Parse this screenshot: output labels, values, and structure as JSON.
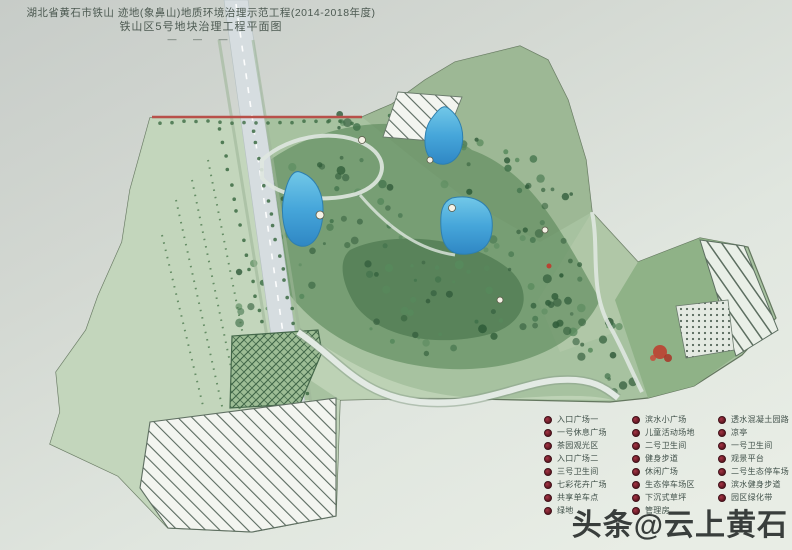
{
  "title": {
    "line1": "湖北省黄石市铁山 迹地(象鼻山)地质环境治理示范工程(2014-2018年度)",
    "line2": "铁山区5号地块治理工程平面图",
    "scale_marks": "— — —"
  },
  "watermark": "头条@云上黄石",
  "legend": {
    "columns": [
      [
        "入口广场一",
        "一号休息广场",
        "茶园观光区",
        "入口广场二",
        "三号卫生间",
        "七彩花卉广场",
        "共享单车点",
        "绿地"
      ],
      [
        "滨水小广场",
        "儿童活动场地",
        "二号卫生间",
        "健身步道",
        "休闲广场",
        "生态停车场区",
        "下沉式草坪",
        "管理房"
      ],
      [
        "透水混凝土园路",
        "凉亭",
        "一号卫生间",
        "观景平台",
        "二号生态停车场",
        "滨水健身步道",
        "园区绿化带"
      ]
    ]
  },
  "map_features": {
    "park": "治理区绿地",
    "ponds": [
      "西侧水塘",
      "北侧水塘",
      "中部水塘"
    ],
    "road": "纵向道路",
    "red_boundary_line": "北侧红线",
    "hatched_zones": [
      "北部整治区",
      "中部网格整治区",
      "南部大面积整治区",
      "东部条带停车区",
      "东部网点区"
    ]
  },
  "colors": {
    "background_top": "#c7ccc8",
    "background_bottom": "#e7ece4",
    "park_green": "#a7c2a0",
    "lawn_green": "#c6d8bf",
    "forest_green": "#3f6f46",
    "water_blue": "#3f9fd6",
    "road_gray": "#d6dde0",
    "red_line": "#b8504a",
    "hatch_line": "#5a6a5f",
    "legend_bullet": "#7a1f2b",
    "watermark_gray": "#393e3c"
  }
}
